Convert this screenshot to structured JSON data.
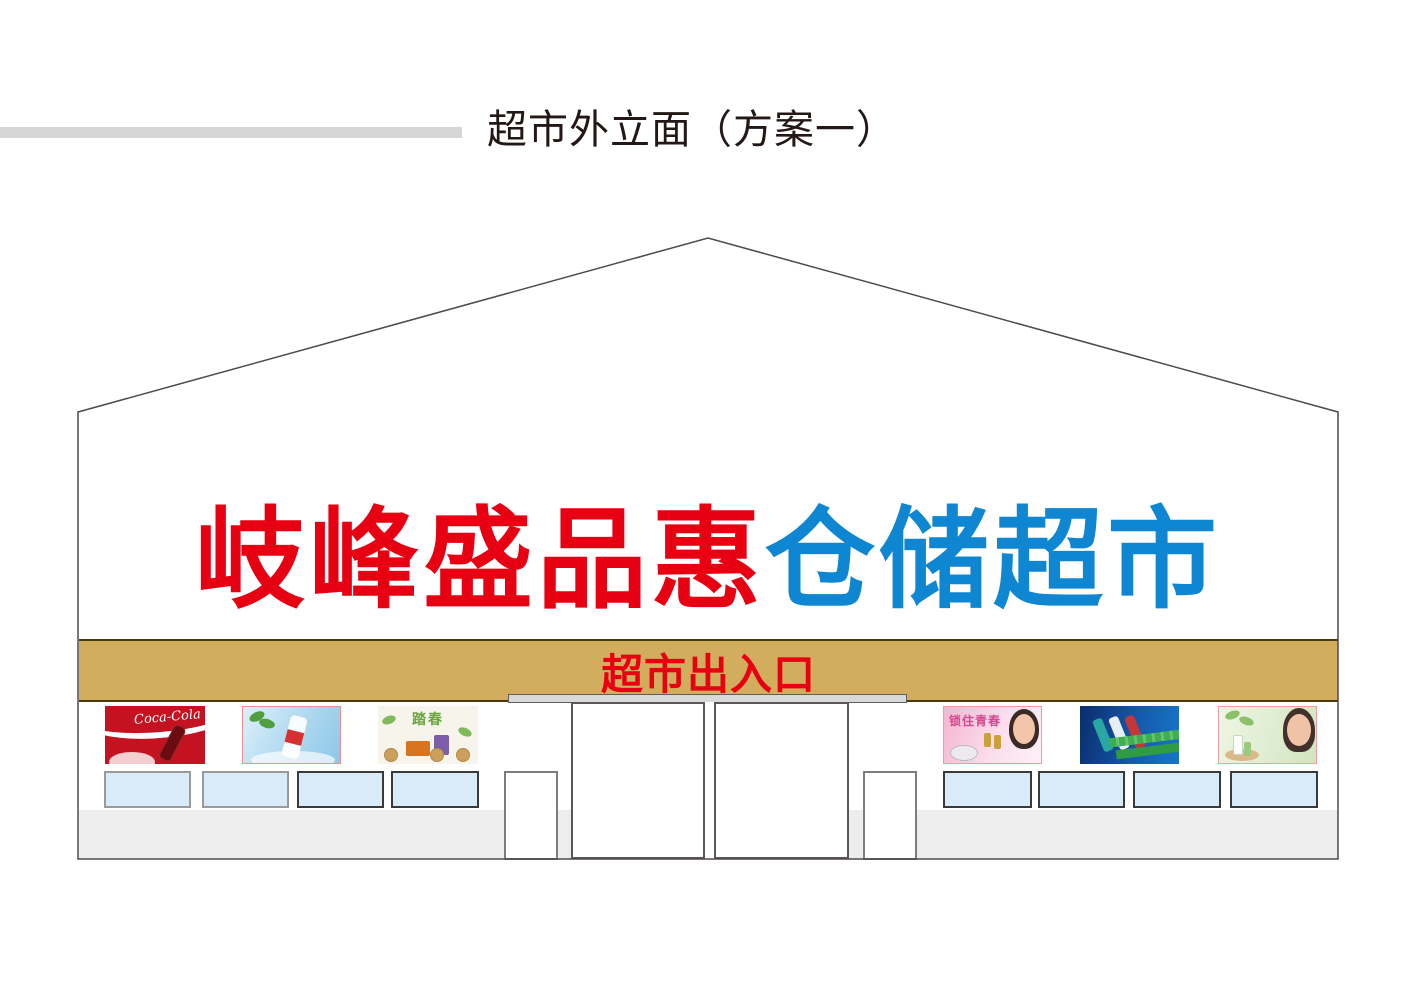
{
  "header": {
    "title": "超市外立面（方案一）"
  },
  "sign": {
    "red_text": "岐峰盛品惠",
    "blue_text": "仓储超市",
    "red_color": "#e60012",
    "blue_color": "#0f86d1"
  },
  "entrance": {
    "label": "超市出入口",
    "band_color": "#d2ad5e",
    "label_color": "#e60012"
  },
  "posters": {
    "cola": {
      "text": "Coca-Cola"
    },
    "pastry": {
      "text": "踏春"
    },
    "cosmetics": {
      "text": "锁住青春"
    }
  },
  "windows": {
    "left_count": 4,
    "right_count": 4,
    "fill_color": "#d9eaf8"
  }
}
